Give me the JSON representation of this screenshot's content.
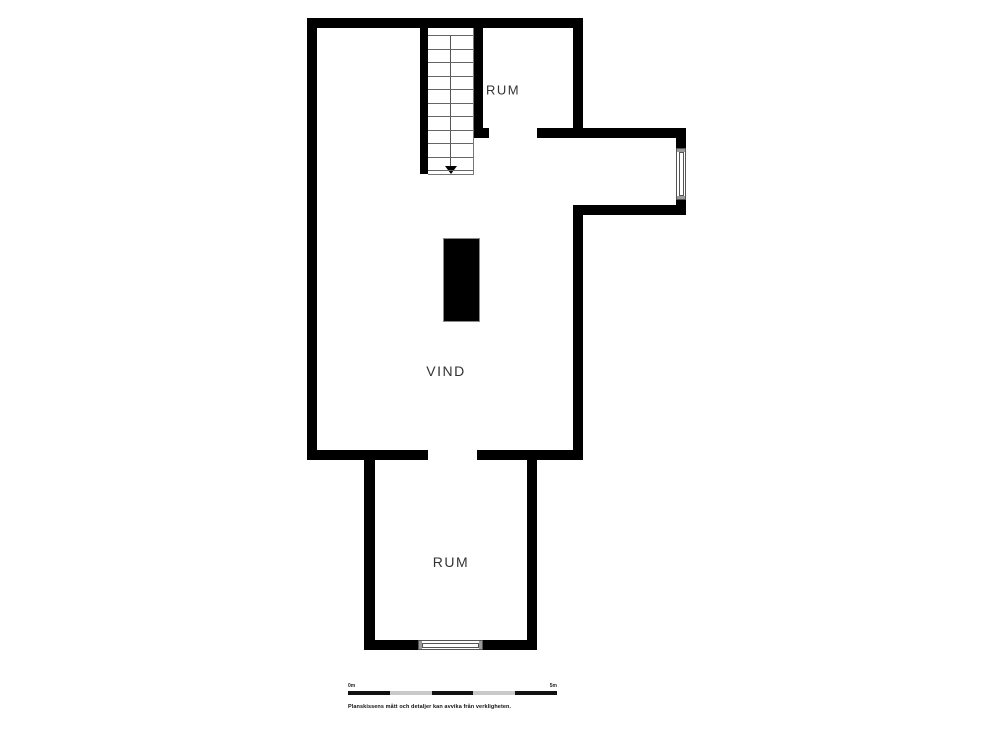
{
  "rooms": {
    "room_top": "RUM",
    "attic": "VIND",
    "room_bottom": "RUM"
  },
  "stairs": {
    "tread_count": 11,
    "direction_arrow": "down"
  },
  "scale_bar": {
    "start_label": "0m",
    "end_label": "5m",
    "segments": 5
  },
  "disclaimer": "Planskissens mått och detaljer kan avvika från verkligheten.",
  "colors": {
    "wall": "#000000",
    "background": "#ffffff",
    "label_text": "#333333",
    "scale_segment_dark": "#111111",
    "scale_segment_gray": "#c9c9c9"
  }
}
